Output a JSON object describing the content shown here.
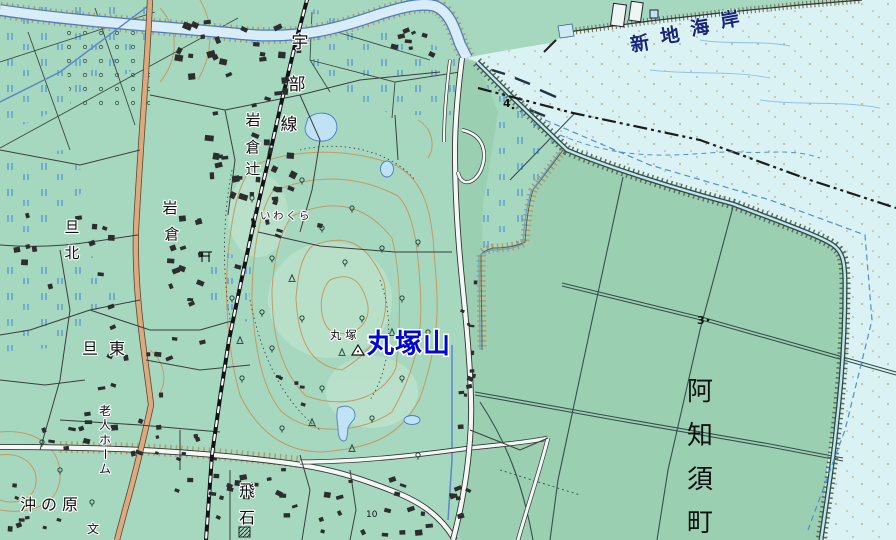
{
  "colors": {
    "land": "#a6d8c0",
    "reclaimed_land": "#9bcfb2",
    "sea": "#daf2f4",
    "river": "#d8edf8",
    "water_line": "#4a7cc4",
    "pond": "#bfe2f4",
    "road_orange": "#dcaa7e",
    "road_casing": "#5a4632",
    "road_white": "#f4f8f4",
    "railway": "#141414",
    "contour": "#c49a62",
    "label_blue": "#0008d2",
    "coast_label_blue": "#16247e",
    "paddy_mark": "#4d8fd6",
    "marsh_mark": "#31544a",
    "boundary": "#1c1c1c",
    "blue_dashed": "#4d8fd6",
    "building": "#2d2d2d",
    "embankment": "#b59a6b"
  },
  "labels": {
    "ube_line": [
      "宇",
      "部",
      "線"
    ],
    "iwakura_tsuji": [
      "岩",
      "倉",
      "辻"
    ],
    "iwakura_hamlet": [
      "岩",
      "倉"
    ],
    "iwakura_station": "いわくら",
    "dan_kita": [
      "旦",
      "北"
    ],
    "dan_higashi": "旦東",
    "marutsuka_small": "丸 塚",
    "marutsukayama": "丸塚山",
    "shinchi_kaigan": [
      "新",
      "地",
      "海",
      "岸"
    ],
    "ajisu_cho": [
      "阿",
      "知",
      "須",
      "町"
    ],
    "rojin_home": [
      "老",
      "人",
      "ホ",
      "ー",
      "ム"
    ],
    "oki_no_hara": "沖の原",
    "tobiishi": [
      "飛",
      "石"
    ],
    "school_symbol": "文"
  },
  "spot_values": {
    "elev_4": "4",
    "elev_3": "3",
    "elev_10": "10"
  }
}
